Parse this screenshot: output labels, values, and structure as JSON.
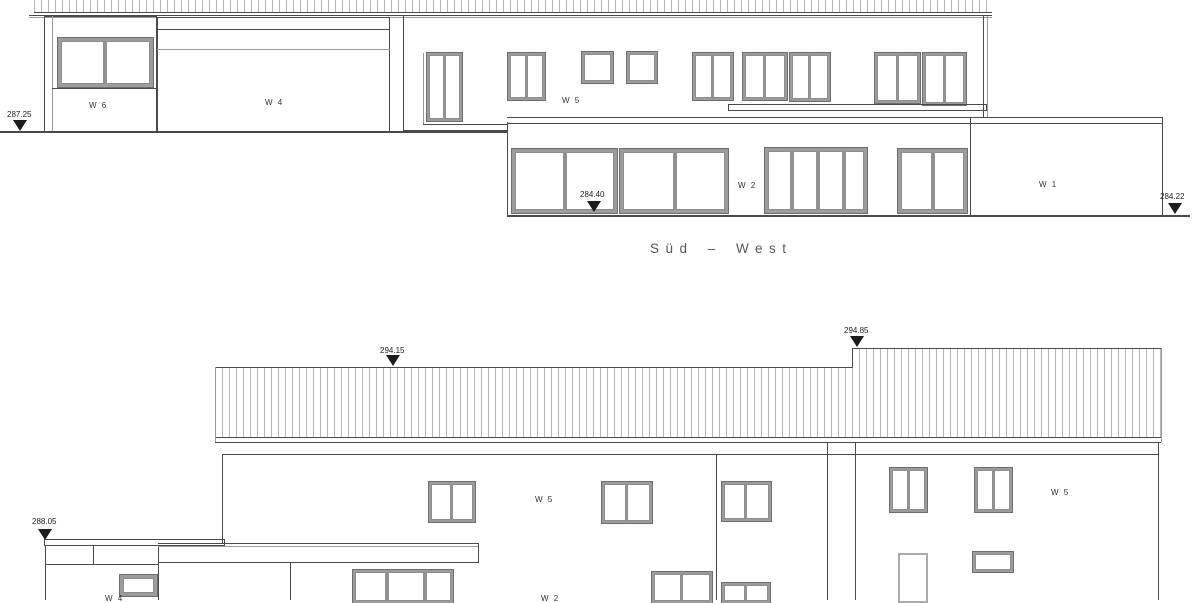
{
  "title": {
    "text": "Süd – West"
  },
  "colors": {
    "line": "#4a4a4a",
    "light": "#9a9a9a",
    "frame": "#9c9c9c",
    "frame_light": "#ababab",
    "hatch": "#b6b6b6",
    "text": "#323232",
    "marker": "#1c1c1c",
    "bg": "#ffffff"
  },
  "labels": [
    {
      "name": "label-w6",
      "text": "W 6",
      "x": 89,
      "y": 101
    },
    {
      "name": "label-w4",
      "text": "W 4",
      "x": 265,
      "y": 98
    },
    {
      "name": "label-w5-top",
      "text": "W 5",
      "x": 562,
      "y": 96
    },
    {
      "name": "label-w2",
      "text": "W 2",
      "x": 738,
      "y": 181
    },
    {
      "name": "label-w1",
      "text": "W 1",
      "x": 1039,
      "y": 180
    },
    {
      "name": "label-w5-bottom-mid",
      "text": "W 5",
      "x": 535,
      "y": 495
    },
    {
      "name": "label-w5-bottom-right",
      "text": "W 5",
      "x": 1051,
      "y": 488
    },
    {
      "name": "label-w4-bottom-clipped",
      "text": "W 4",
      "x": 105,
      "y": 594
    },
    {
      "name": "label-w2-bottom-clipped",
      "text": "W 2",
      "x": 541,
      "y": 594
    }
  ],
  "markers": [
    {
      "name": "marker-287-25",
      "value": "287.25",
      "tx": 7,
      "ty": 110,
      "cx": 20,
      "tip": 131
    },
    {
      "name": "marker-284-40",
      "value": "284.40",
      "tx": 580,
      "ty": 190,
      "cx": 594,
      "tip": 212
    },
    {
      "name": "marker-284-22",
      "value": "284.22",
      "tx": 1160,
      "ty": 192,
      "cx": 1175,
      "tip": 214
    },
    {
      "name": "marker-294-15",
      "value": "294.15",
      "tx": 380,
      "ty": 346,
      "cx": 393,
      "tip": 366
    },
    {
      "name": "marker-294-85",
      "value": "294.85",
      "tx": 844,
      "ty": 326,
      "cx": 857,
      "tip": 347
    },
    {
      "name": "marker-288-05",
      "value": "288.05",
      "tx": 32,
      "ty": 517,
      "cx": 45,
      "tip": 540
    }
  ],
  "shapes": [
    {
      "n": "top-roof-hatch",
      "t": "hatch",
      "x": 34,
      "y": 0,
      "w": 958,
      "h": 13,
      "noTop": true
    },
    {
      "n": "top-roof-eaves-line",
      "t": "hline",
      "x": 29,
      "y": 15,
      "w": 963
    },
    {
      "n": "top-roof-eaves-line-2",
      "t": "hline",
      "x": 29,
      "y": 17,
      "w": 963,
      "c": "l"
    },
    {
      "n": "w6-wall",
      "t": "rect",
      "x": 44,
      "y": 16,
      "w": 113,
      "h": 116
    },
    {
      "n": "w6-wall-inner-line",
      "t": "vline",
      "x": 52,
      "y": 16,
      "h": 116,
      "c": "l"
    },
    {
      "n": "w6-window",
      "t": "win",
      "x": 58,
      "y": 38,
      "w": 95,
      "h": 49,
      "bw": 3,
      "m": [
        42
      ],
      "mw": 4
    },
    {
      "n": "w6-sill-line",
      "t": "hline",
      "x": 52,
      "y": 88,
      "w": 105
    },
    {
      "n": "w4-wall",
      "t": "rect",
      "x": 157,
      "y": 17,
      "w": 233,
      "h": 116
    },
    {
      "n": "w4-roof-line",
      "t": "hline",
      "x": 157,
      "y": 29,
      "w": 233
    },
    {
      "n": "w4-door-top-line",
      "t": "hline",
      "x": 157,
      "y": 49,
      "w": 233,
      "c": "l"
    },
    {
      "n": "main-wall-left-edge",
      "t": "vline",
      "x": 403,
      "y": 16,
      "h": 114
    },
    {
      "n": "main-wall-corner-line",
      "t": "vline",
      "x": 423,
      "y": 53,
      "h": 71,
      "c": "l"
    },
    {
      "n": "main-wall-right-edge",
      "t": "vline",
      "x": 983,
      "y": 16,
      "h": 101
    },
    {
      "n": "main-wall-right-edge-2",
      "t": "vline",
      "x": 987,
      "y": 16,
      "h": 101,
      "c": "l"
    },
    {
      "n": "main-wall-bottom-line",
      "t": "hline",
      "x": 403,
      "y": 130,
      "w": 104
    },
    {
      "n": "fascia-line-top",
      "t": "hline",
      "x": 507,
      "y": 117,
      "w": 655
    },
    {
      "n": "fascia-line-bottom",
      "t": "hline",
      "x": 507,
      "y": 123,
      "w": 655
    },
    {
      "n": "terrace-door-window",
      "t": "win",
      "x": 427,
      "y": 53,
      "w": 35,
      "h": 68,
      "bw": 2,
      "m": [
        14
      ],
      "mw": 3
    },
    {
      "n": "terrace-door-sill",
      "t": "hline",
      "x": 423,
      "y": 124,
      "w": 84
    },
    {
      "n": "upper-window-1",
      "t": "win",
      "x": 508,
      "y": 53,
      "w": 37,
      "h": 47,
      "bw": 2,
      "m": [
        15
      ],
      "mw": 3
    },
    {
      "n": "upper-square-window-1",
      "t": "win",
      "x": 582,
      "y": 52,
      "w": 31,
      "h": 31,
      "bw": 2,
      "m": []
    },
    {
      "n": "upper-square-window-2",
      "t": "win",
      "x": 627,
      "y": 52,
      "w": 30,
      "h": 31,
      "bw": 2,
      "m": []
    },
    {
      "n": "upper-window-2",
      "t": "win",
      "x": 693,
      "y": 53,
      "w": 40,
      "h": 47,
      "bw": 2,
      "m": [
        16
      ],
      "mw": 3
    },
    {
      "n": "upper-window-3",
      "t": "win",
      "x": 743,
      "y": 53,
      "w": 44,
      "h": 47,
      "bw": 2,
      "m": [
        18
      ],
      "mw": 3
    },
    {
      "n": "upper-window-4",
      "t": "win",
      "x": 790,
      "y": 53,
      "w": 40,
      "h": 48,
      "bw": 2,
      "m": [
        16
      ],
      "mw": 3
    },
    {
      "n": "upper-window-5",
      "t": "win",
      "x": 875,
      "y": 53,
      "w": 45,
      "h": 50,
      "bw": 2,
      "m": [
        19
      ],
      "mw": 3
    },
    {
      "n": "upper-window-6",
      "t": "win",
      "x": 923,
      "y": 53,
      "w": 43,
      "h": 52,
      "bw": 2,
      "m": [
        18
      ],
      "mw": 3
    },
    {
      "n": "balcony-rail-band",
      "t": "rect",
      "x": 728,
      "y": 104,
      "w": 259,
      "h": 7
    },
    {
      "n": "w2-block-left-edge",
      "t": "vline",
      "x": 507,
      "y": 122,
      "h": 94
    },
    {
      "n": "w2-block-right-edge",
      "t": "vline",
      "x": 970,
      "y": 117,
      "h": 99
    },
    {
      "n": "w2-slider-1",
      "t": "win",
      "x": 512,
      "y": 149,
      "w": 105,
      "h": 64,
      "bw": 3,
      "m": [
        48
      ],
      "mw": 4
    },
    {
      "n": "w2-slider-2",
      "t": "win",
      "x": 620,
      "y": 149,
      "w": 108,
      "h": 64,
      "bw": 3,
      "m": [
        50
      ],
      "mw": 4
    },
    {
      "n": "w2-folding-door",
      "t": "win",
      "x": 765,
      "y": 148,
      "w": 102,
      "h": 65,
      "bw": 3,
      "m": [
        22,
        48,
        74
      ],
      "mw": 4
    },
    {
      "n": "w2-slider-3",
      "t": "win",
      "x": 898,
      "y": 149,
      "w": 69,
      "h": 64,
      "bw": 3,
      "m": [
        30
      ],
      "mw": 4
    },
    {
      "n": "w1-right-edge",
      "t": "vline",
      "x": 1162,
      "y": 117,
      "h": 99
    },
    {
      "n": "terrain-line-left",
      "t": "hline",
      "x": 0,
      "y": 131,
      "w": 507,
      "th": 2
    },
    {
      "n": "terrain-line-right",
      "t": "hline",
      "x": 507,
      "y": 215,
      "w": 683,
      "th": 2
    },
    {
      "n": "roof-a-hatch",
      "t": "hatch",
      "x": 215,
      "y": 367,
      "w": 637,
      "h": 71
    },
    {
      "n": "roof-b-hatch",
      "t": "hatch",
      "x": 852,
      "y": 348,
      "w": 309,
      "h": 90
    },
    {
      "n": "roof-b-step-edge",
      "t": "vline",
      "x": 852,
      "y": 348,
      "h": 20
    },
    {
      "n": "roof-a-left-edge",
      "t": "vline",
      "x": 215,
      "y": 367,
      "h": 75,
      "c": "l"
    },
    {
      "n": "roof-b-right-edge",
      "t": "vline",
      "x": 1161,
      "y": 348,
      "h": 94,
      "c": "l"
    },
    {
      "n": "eaves-line-bottom-1",
      "t": "hline",
      "x": 215,
      "y": 442,
      "w": 946
    },
    {
      "n": "eaves-line-bottom-2",
      "t": "hline",
      "x": 222,
      "y": 454,
      "w": 936
    },
    {
      "n": "bwall-left-edge",
      "t": "vline",
      "x": 222,
      "y": 455,
      "h": 88
    },
    {
      "n": "bwall-divider",
      "t": "vline",
      "x": 716,
      "y": 455,
      "h": 145
    },
    {
      "n": "bwall-recess-line-1",
      "t": "vline",
      "x": 827,
      "y": 443,
      "h": 157
    },
    {
      "n": "bwall-recess-line-2",
      "t": "vline",
      "x": 855,
      "y": 443,
      "h": 157
    },
    {
      "n": "bwall-right-edge",
      "t": "vline",
      "x": 1158,
      "y": 443,
      "h": 157
    },
    {
      "n": "bupper-window-1",
      "t": "win",
      "x": 429,
      "y": 482,
      "w": 46,
      "h": 40,
      "bw": 2,
      "m": [
        19
      ],
      "mw": 3
    },
    {
      "n": "bupper-window-2",
      "t": "win",
      "x": 602,
      "y": 482,
      "w": 50,
      "h": 41,
      "bw": 2,
      "m": [
        21
      ],
      "mw": 3
    },
    {
      "n": "bupper-window-3",
      "t": "win",
      "x": 722,
      "y": 482,
      "w": 49,
      "h": 39,
      "bw": 2,
      "m": [
        20
      ],
      "mw": 3
    },
    {
      "n": "bupper-window-4",
      "t": "win",
      "x": 890,
      "y": 468,
      "w": 37,
      "h": 44,
      "bw": 2,
      "m": [
        15
      ],
      "mw": 3
    },
    {
      "n": "bupper-window-5",
      "t": "win",
      "x": 975,
      "y": 468,
      "w": 37,
      "h": 44,
      "bw": 2,
      "m": [
        15
      ],
      "mw": 3
    },
    {
      "n": "lowleft-parapet",
      "t": "rect",
      "x": 44,
      "y": 539,
      "w": 181,
      "h": 7
    },
    {
      "n": "lowleft-left-edge",
      "t": "vline",
      "x": 45,
      "y": 546,
      "h": 54
    },
    {
      "n": "lowleft-inner-line",
      "t": "vline",
      "x": 93,
      "y": 546,
      "h": 19
    },
    {
      "n": "lowleft-sill-line",
      "t": "hline",
      "x": 45,
      "y": 564,
      "w": 114
    },
    {
      "n": "lowleft-small-window",
      "t": "win",
      "x": 120,
      "y": 575,
      "w": 37,
      "h": 21,
      "bw": 3,
      "m": []
    },
    {
      "n": "lowleft-wall-edge",
      "t": "vline",
      "x": 158,
      "y": 546,
      "h": 54
    },
    {
      "n": "canopy-line-top",
      "t": "hline",
      "x": 158,
      "y": 543,
      "w": 320
    },
    {
      "n": "canopy-line-inner",
      "t": "hline",
      "x": 158,
      "y": 546,
      "w": 320,
      "c": "l"
    },
    {
      "n": "canopy-line-bottom",
      "t": "hline",
      "x": 158,
      "y": 562,
      "w": 320
    },
    {
      "n": "canopy-right-edge",
      "t": "vline",
      "x": 478,
      "y": 543,
      "h": 20
    },
    {
      "n": "bground-wall-line",
      "t": "vline",
      "x": 290,
      "y": 563,
      "h": 37
    },
    {
      "n": "bground-glazing",
      "t": "win",
      "x": 353,
      "y": 570,
      "w": 100,
      "h": 33,
      "bw": 2,
      "m": [
        30,
        68
      ],
      "mw": 4
    },
    {
      "n": "bground-window-1",
      "t": "win",
      "x": 652,
      "y": 572,
      "w": 60,
      "h": 31,
      "bw": 2,
      "m": [
        26
      ],
      "mw": 3
    },
    {
      "n": "bground-window-2",
      "t": "win",
      "x": 722,
      "y": 583,
      "w": 48,
      "h": 20,
      "bw": 2,
      "m": [
        20
      ],
      "mw": 3
    },
    {
      "n": "bground-door",
      "t": "win",
      "x": 898,
      "y": 553,
      "w": 30,
      "h": 50,
      "bw": 2,
      "m": [],
      "f": "l"
    },
    {
      "n": "bground-window-3",
      "t": "win",
      "x": 973,
      "y": 552,
      "w": 40,
      "h": 20,
      "bw": 2,
      "m": []
    }
  ]
}
